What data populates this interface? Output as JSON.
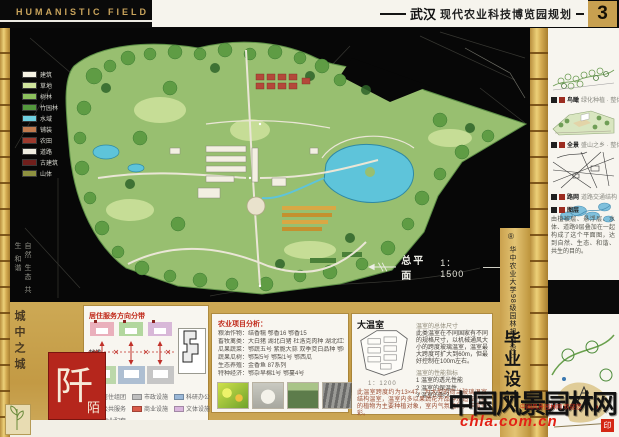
{
  "header": {
    "program": "HUMANISTIC FIELD",
    "city": "武汉",
    "title": "现代农业科技博览园规划",
    "page": "3"
  },
  "map": {
    "plan_label": "总平面",
    "plan_scale": "1：1500",
    "motto": "自然 生态 共生 和谐",
    "legend": [
      {
        "label": "建筑",
        "color": "#f5f2e4"
      },
      {
        "label": "草地",
        "color": "#cfe49c"
      },
      {
        "label": "树林",
        "color": "#8cc05c"
      },
      {
        "label": "竹园林",
        "color": "#53973c"
      },
      {
        "label": "水域",
        "color": "#6fd0e0"
      },
      {
        "label": "铺装",
        "color": "#c07a4e"
      },
      {
        "label": "农田",
        "color": "#9c3a2e"
      },
      {
        "label": "道路",
        "color": "#efece0"
      },
      {
        "label": "古建筑",
        "color": "#701f1c"
      },
      {
        "label": "山体",
        "color": "#8e9140"
      }
    ]
  },
  "right_panel": {
    "sketches": [
      {
        "tag": "鸟瞰",
        "caption": "绿化种植 · 整体鸟瞰"
      },
      {
        "tag": "全景",
        "caption": "盛山之乡 · 整体全景"
      },
      {
        "tag": "路网",
        "caption": "道路交通结构 · 车行步行"
      },
      {
        "tag": "水系",
        "caption": "水系结构分析"
      }
    ],
    "summary_tag": "图层",
    "summary": "由植被层、悬浮层、水体、道路9层叠加在一起构成了这个平面图，达到自然、生态、和谐、共生的目的。"
  },
  "side_strip": {
    "mark": "®",
    "school": "华中农业大学98级园林规划设计",
    "degree": "毕业设计"
  },
  "bottom": {
    "city_motto": "城中之城",
    "seal_main": "阡",
    "seal_sub": "陌",
    "zoning": {
      "title": "居住服务方向分带",
      "axis_label": "轴线",
      "legend": [
        {
          "label": "居住组团",
          "color": "#e9aeb6"
        },
        {
          "label": "公共服务",
          "color": "#a8d49a"
        },
        {
          "label": "文体设施",
          "color": "#d9b6dd"
        },
        {
          "label": "市政设施",
          "color": "#bfbfbf"
        },
        {
          "label": "商业设施",
          "color": "#d85a48"
        },
        {
          "label": "物业配套",
          "color": "#a03028"
        },
        {
          "label": "科研办公",
          "color": "#9ab8d8"
        }
      ]
    },
    "agriculture": {
      "title": "农业项目分析：",
      "lines": [
        "粮油作物：结香糯 鄂香16 鄂香15",
        "畜牧禽类：大白猪 湖北白猪 杜洛克肉种 湖北红鸡 金水乌鸡",
        "瓜果蔬菜：鄂蔬五号 紫脆大蒜 双季茭白品种 鄂椒 成菜",
        "蔬果瓜树：鄂梨5号 鄂梨1号 鄂西瓜",
        "生态养殖：金香鱼 87系列",
        "特种经济：鄂杂早棉1号 鄂蔓4号"
      ]
    },
    "greenhouse": {
      "title": "大温室",
      "scale": "1：1200",
      "subhead1": "温室的总体尺寸",
      "para1": "此类温室在不同国家有不同的规格尺寸，以机械通风大小的跨度玻璃温室，温室最大跨度可扩大到60m，但最好控制在100m左右。",
      "subhead2": "温室的性能指标",
      "list": [
        "1 温室的透光性能",
        "2 温室的保温性",
        "3 温室的耐久"
      ],
      "para2": "此温室跨度约为13×47，为大型的荷兰玻璃温室结构温室，温室内多以果蔬花卉品种及适应气候的植物为主要种植对象，室内气氛温和，丰富多彩。"
    }
  },
  "watermark": {
    "brand": "中国风景园林网",
    "credit": "中国风景园林网 欢迎您",
    "url": "chla.com.cn",
    "seal": "印"
  }
}
